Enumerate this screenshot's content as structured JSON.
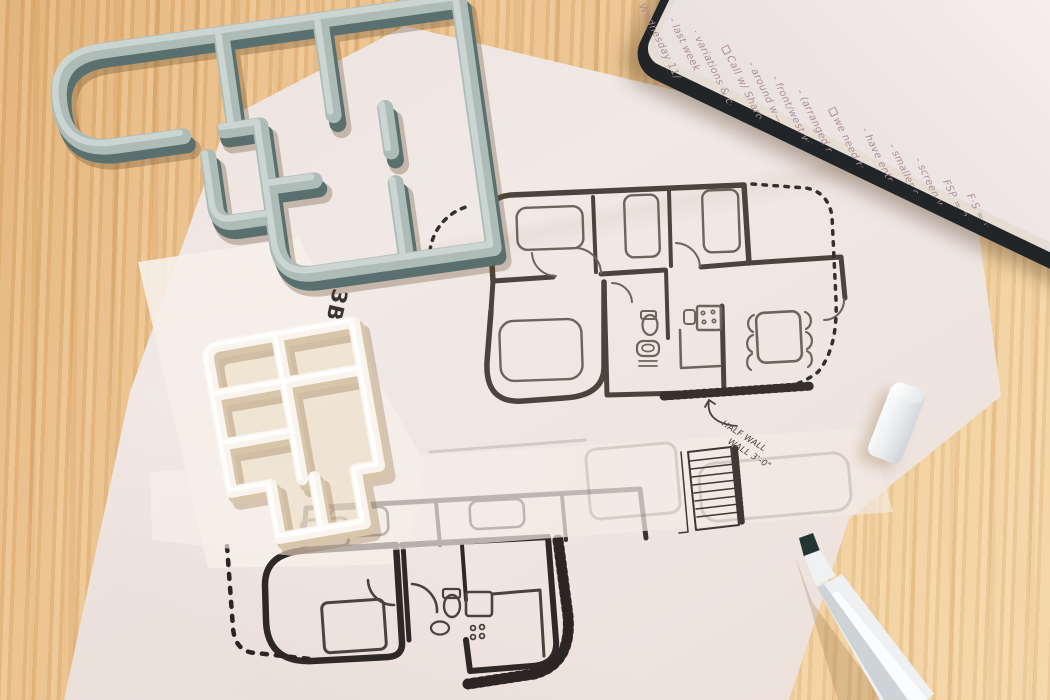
{
  "scene_title": "Floor plan sketches with 3D printed models on a wood desk",
  "objects": [
    "wood-table",
    "gray-3d-printed-floor-plan-model",
    "white-3d-printed-floor-plan-model",
    "tracing-paper-sheets",
    "main-floor-plan-sketch",
    "second-floor-plan-sketch",
    "notebook-with-handwritten-notes",
    "white-marker-cap",
    "white-chisel-tip-marker"
  ],
  "sketch": {
    "bedroom_label": "3BR",
    "annotation_line1": "HALF WALL",
    "annotation_line2": "WALL 3'-0\""
  },
  "notebook": {
    "lines": [
      {
        "text": "Wednesday 11/",
        "checkbox": false,
        "underline": true
      },
      {
        "text": "- last week",
        "checkbox": false,
        "underline": false
      },
      {
        "text": "· variations & c—",
        "checkbox": false,
        "underline": false
      },
      {
        "text": "Call w/ Sharon",
        "checkbox": true,
        "underline": false
      },
      {
        "text": "- around w—",
        "checkbox": false,
        "underline": false
      },
      {
        "text": "- front/west wing",
        "checkbox": false,
        "underline": false
      },
      {
        "text": "- (arranged ref—",
        "checkbox": false,
        "underline": false
      },
      {
        "text": "we need to go to—",
        "checkbox": true,
        "underline": false
      },
      {
        "text": "- have entrance",
        "checkbox": false,
        "underline": false
      },
      {
        "text": "- smaller openings of",
        "checkbox": false,
        "underline": false
      },
      {
        "text": "- screen walls",
        "checkbox": false,
        "underline": false
      },
      {
        "text": "FSP = 2½",
        "checkbox": false,
        "underline": false
      },
      {
        "text": "F·S = wk",
        "checkbox": false,
        "underline": false
      }
    ]
  },
  "colors": {
    "wood-base": "#e8bd87",
    "paper-main": "#efe6e2",
    "paper-bright": "#f5eee7",
    "ink-dark": "#2e2927",
    "ink-mid": "#4d433d",
    "ink-light": "#75695f",
    "model-gray": "#aebcb8",
    "model-gray-shadow": "#5a706e",
    "model-gray-light": "#ccd6d2",
    "model-white": "#f9f5ee",
    "model-white-shadow": "#d8c6ab",
    "notebook-cover": "#222528",
    "notebook-page": "#f5eeee",
    "handwriting": "#ae8e97",
    "marker-body": "#eef0f2",
    "marker-tip": "#243634"
  }
}
